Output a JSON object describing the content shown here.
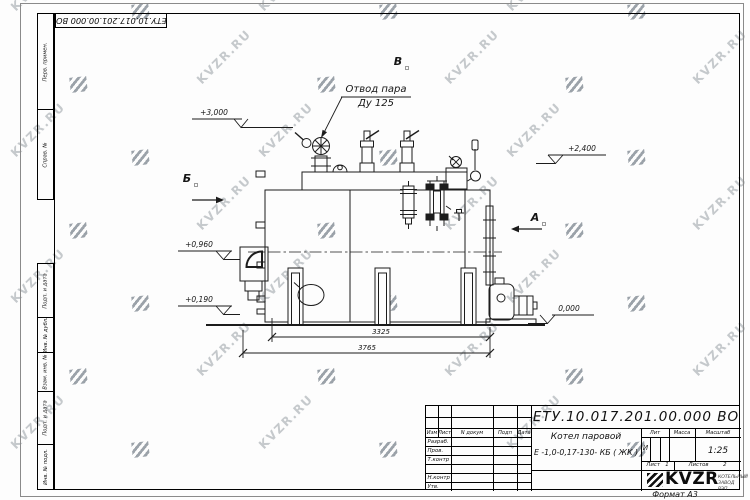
{
  "watermark": {
    "text": "KVZR.RU"
  },
  "frame": {
    "doc_number_flipped": "ЕТУ.10.017.201.00.000  ВО",
    "format_label": "Формат А3",
    "margin_stamps_top": [
      "Перв. примен.",
      "Справ. №"
    ],
    "margin_stamps_bottom": [
      "Подп. и дата",
      "Инв. № дубл.",
      "Взам. инв. №",
      "Подп. и дата",
      "Инв. № подл."
    ]
  },
  "drawing": {
    "callout": {
      "line1": "Отвод пара",
      "line2": "Ду 125"
    },
    "elevations": [
      "+3,000",
      "+2,400",
      "+0,960",
      "+0,190",
      "0,000"
    ],
    "dimensions": [
      "3325",
      "3765"
    ],
    "section_labels": [
      "Б",
      "В",
      "А"
    ]
  },
  "title_block": {
    "doc_number": "ЕТУ.10.017.201.00.000  ВО",
    "product_line1": "Котел паровой",
    "product_line2": "Е -1,0-0,17-130- КБ ( ЖК )",
    "headers": {
      "izm": "Изм",
      "list": "Лист",
      "n_dokum": "N докум",
      "podp": "Подп",
      "data": "Дата",
      "lit": "Лит",
      "massa": "Масса",
      "masshtab": "Масштаб"
    },
    "row_labels": [
      "Разраб.",
      "Пров.",
      "Т.контр",
      "Н.контр",
      "Утв."
    ],
    "lit_value": "И",
    "scale_value": "1:25",
    "sheet": {
      "label": "Лист",
      "value": "1",
      "total_label": "Листов",
      "total_value": "2"
    },
    "logo": {
      "text": "KVZR",
      "sub_line1": "КОТЕЛЬНЫЙ",
      "sub_line2": "ЗАВОД РЭП"
    }
  }
}
